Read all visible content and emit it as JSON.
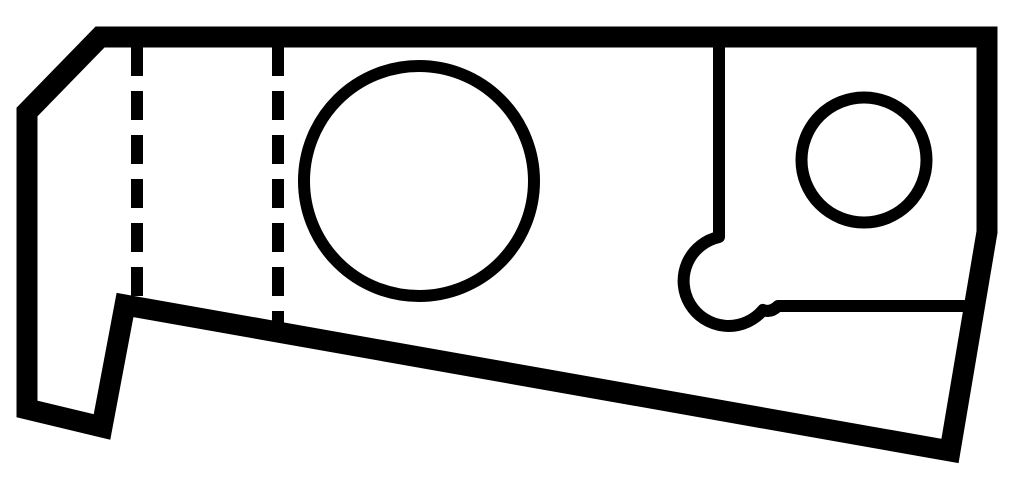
{
  "canvas": {
    "width": 1024,
    "height": 492,
    "background": "#ffffff",
    "ink": "#000000"
  },
  "drawing": {
    "outline": {
      "name": "part-outline",
      "stroke_width": 21,
      "points": [
        [
          100,
          37
        ],
        [
          987,
          37
        ],
        [
          987,
          232
        ],
        [
          950,
          451
        ],
        [
          125,
          305
        ],
        [
          102,
          427
        ],
        [
          27,
          409
        ],
        [
          27,
          112
        ]
      ]
    },
    "interior_stroke_width": 12,
    "circles": [
      {
        "name": "large-hole",
        "cx": 419,
        "cy": 181,
        "r": 115
      },
      {
        "name": "small-hole",
        "cx": 864,
        "cy": 160,
        "r": 62.5
      }
    ],
    "dashed_lines": [
      {
        "name": "hidden-line-left",
        "x": 137,
        "y1": 40,
        "y2": 300,
        "dash": "29 15",
        "dash_offset": 37
      },
      {
        "name": "hidden-line-right",
        "x": 278,
        "y1": 40,
        "y2": 326,
        "dash": "29 15",
        "dash_offset": 37
      }
    ],
    "paths": [
      {
        "name": "relief-slot",
        "d": "M 719 40 L 719 237 A 45 45 0 1 0 763 310 Q 771 313 778 306 L 972 306"
      }
    ]
  }
}
